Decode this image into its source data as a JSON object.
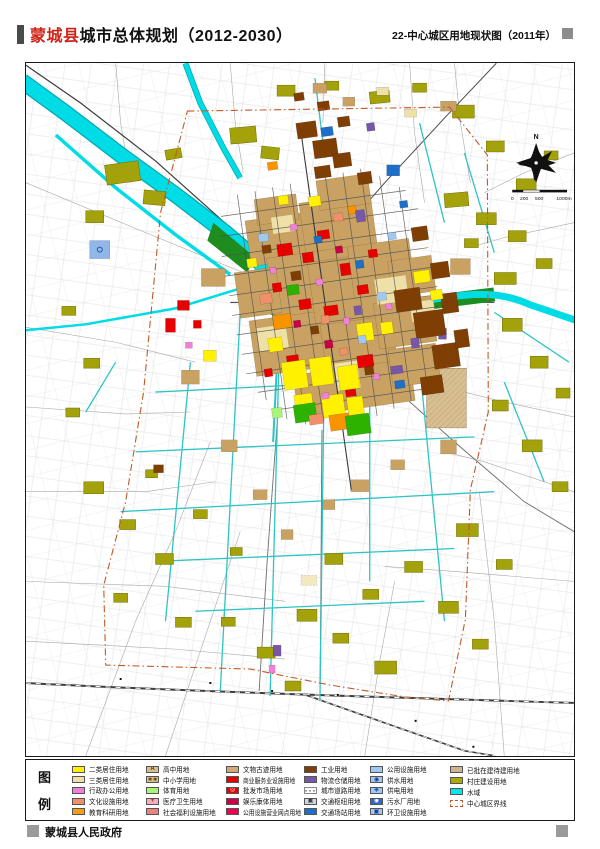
{
  "header": {
    "title_red": "蒙城县",
    "title_black": "城市总体规划（2012-2030）",
    "right_title": "22-中心城区用地现状图（2011年）"
  },
  "map": {
    "compass_label": "N",
    "scale_labels": [
      "0",
      "200",
      "500",
      "1000m"
    ],
    "boundary_color": "#c05a28",
    "water_color": "#00dce6",
    "village_color": "#a4a20a"
  },
  "legend": {
    "title_top": "图",
    "title_bottom": "例",
    "columns": [
      {
        "items": [
          {
            "label": "二类居住用地",
            "color": "#fff100"
          },
          {
            "label": "三类居住用地",
            "color": "#efdfa4"
          },
          {
            "label": "行政办公用地",
            "color": "#f07fd8"
          },
          {
            "label": "文化设施用地",
            "color": "#f0906a"
          },
          {
            "label": "教育科研用地",
            "color": "#f79e17"
          }
        ]
      },
      {
        "items": [
          {
            "label": "高中用地",
            "color": "#d9be8c",
            "symbol": "A",
            "symbol_color": "#5a3a00"
          },
          {
            "label": "中小学用地",
            "color": "#d9be8c",
            "symbol": "∗∗",
            "symbol_color": "#5a3a00"
          },
          {
            "label": "体育用地",
            "color": "#a8f577"
          },
          {
            "label": "医疗卫生用地",
            "color": "#f2afc0",
            "symbol": "+",
            "symbol_color": "#d40000"
          },
          {
            "label": "社会福利设施用地",
            "color": "#f08080"
          }
        ]
      },
      {
        "items": [
          {
            "label": "文物古迹用地",
            "color": "#d2a878"
          },
          {
            "label": "商业服务业设施用地",
            "color": "#e60000"
          },
          {
            "label": "批发市场用地",
            "color": "#e60000",
            "symbol": "◎",
            "symbol_color": "#ffffff"
          },
          {
            "label": "娱乐康体用地",
            "color": "#cc0045"
          },
          {
            "label": "公用设施营业网点用地",
            "color": "#f0004e"
          }
        ]
      },
      {
        "items": [
          {
            "label": "工业用地",
            "color": "#7e3e04"
          },
          {
            "label": "物流仓储用地",
            "color": "#7757a8"
          },
          {
            "label": "城市道路用地",
            "color": "#ffffff",
            "style": "hatch"
          },
          {
            "label": "交通枢纽用地",
            "color": "#cbd6e4",
            "symbol": "▣",
            "symbol_color": "#333333"
          },
          {
            "label": "交通场站用地",
            "color": "#1e6fc8"
          }
        ]
      },
      {
        "items": [
          {
            "label": "公用设施用地",
            "color": "#9fc9f3"
          },
          {
            "label": "供水用地",
            "color": "#9fc9f3",
            "symbol": "◉",
            "symbol_color": "#1a3a8c"
          },
          {
            "label": "供电用地",
            "color": "#9fc9f3",
            "symbol": "◈",
            "symbol_color": "#1a3a8c"
          },
          {
            "label": "污水厂用地",
            "color": "#2e66c8",
            "symbol": "◉",
            "symbol_color": "#ffffff"
          },
          {
            "label": "环卫设施用地",
            "color": "#9fc9f3",
            "symbol": "▣",
            "symbol_color": "#1a3a8c"
          }
        ]
      },
      {
        "items": [
          {
            "label": "已批在建待建用地",
            "color": "#d2b48c"
          },
          {
            "label": "村庄建设用地",
            "color": "#afa800"
          },
          {
            "label": "水域",
            "color": "#00e5ee"
          },
          {
            "label": "中心城区界线",
            "color": "#ffffff",
            "style": "boundary"
          }
        ]
      }
    ]
  },
  "footer": {
    "text": "蒙城县人民政府"
  }
}
